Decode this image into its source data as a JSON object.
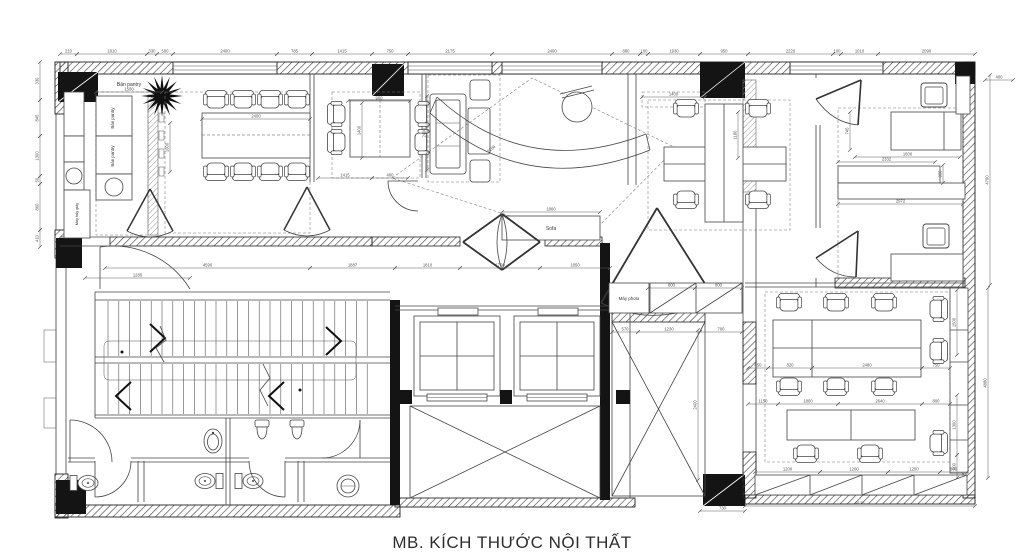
{
  "title": "MB. KÍCH THƯỚC NỘI THẤT",
  "labels": {
    "pantry_counter_top": "Bàn pantry",
    "pantry_counter_1": "Bàn pantry",
    "pantry_counter_2": "Bàn pantry",
    "paper_shredder": "Máy hủy giấy",
    "sofa_bench": "Sofa",
    "photocopier": "Máy photo"
  },
  "colors": {
    "wall": "#141414",
    "line": "#3f3f3f",
    "dim": "#5a5a5a",
    "text": "#2e2e2e"
  },
  "dimensions": {
    "horizontal": [
      [
        60,
        77,
        54,
        "210"
      ],
      [
        77,
        147,
        54,
        "1810"
      ],
      [
        147,
        157,
        54,
        "330"
      ],
      [
        157,
        173,
        54,
        "500"
      ],
      [
        173,
        277,
        54,
        "2400"
      ],
      [
        277,
        312,
        54,
        "785"
      ],
      [
        312,
        372,
        54,
        "1415"
      ],
      [
        372,
        408,
        54,
        "750"
      ],
      [
        408,
        492,
        54,
        "2175"
      ],
      [
        492,
        612,
        54,
        "2400"
      ],
      [
        612,
        640,
        54,
        "880"
      ],
      [
        640,
        648,
        54,
        "100"
      ],
      [
        648,
        700,
        54,
        "1930"
      ],
      [
        700,
        748,
        54,
        "950"
      ],
      [
        748,
        833,
        54,
        "2220"
      ],
      [
        833,
        841,
        54,
        "100"
      ],
      [
        841,
        878,
        54,
        "1010"
      ],
      [
        878,
        975,
        54,
        "2090"
      ],
      [
        96,
        162,
        92,
        "1500"
      ],
      [
        202,
        310,
        119,
        "2400"
      ],
      [
        348,
        410,
        101,
        "900"
      ],
      [
        318,
        372,
        178,
        "1415"
      ],
      [
        372,
        408,
        178,
        "400"
      ],
      [
        642,
        705,
        97,
        "1400"
      ],
      [
        502,
        600,
        212,
        "1800"
      ],
      [
        105,
        310,
        268,
        "4590"
      ],
      [
        310,
        395,
        268,
        "1887"
      ],
      [
        395,
        460,
        268,
        "1810"
      ],
      [
        460,
        540,
        268,
        "1750"
      ],
      [
        540,
        610,
        268,
        "1850"
      ],
      [
        85,
        190,
        278,
        "1280"
      ],
      [
        648,
        695,
        288,
        "800"
      ],
      [
        695,
        742,
        288,
        "800"
      ],
      [
        612,
        638,
        332,
        "570"
      ],
      [
        638,
        700,
        332,
        "1230"
      ],
      [
        700,
        742,
        332,
        "700"
      ],
      [
        855,
        960,
        157,
        "1600"
      ],
      [
        838,
        935,
        162,
        "2332"
      ],
      [
        838,
        963,
        204,
        "2972"
      ],
      [
        985,
        1013,
        80,
        "400"
      ],
      [
        748,
        768,
        368,
        "850"
      ],
      [
        768,
        812,
        368,
        "820"
      ],
      [
        812,
        922,
        368,
        "2480"
      ],
      [
        922,
        950,
        368,
        "750"
      ],
      [
        748,
        778,
        404,
        "1150"
      ],
      [
        778,
        838,
        404,
        "1800"
      ],
      [
        838,
        922,
        404,
        "2640"
      ],
      [
        922,
        950,
        404,
        "800"
      ],
      [
        755,
        820,
        472,
        "1200"
      ],
      [
        820,
        888,
        472,
        "1200"
      ],
      [
        888,
        940,
        472,
        "1200"
      ],
      [
        940,
        967,
        472,
        "800"
      ],
      [
        745,
        975,
        506,
        "9125"
      ],
      [
        700,
        745,
        511,
        "730"
      ]
    ],
    "vertical": [
      [
        62,
        100,
        40,
        "330"
      ],
      [
        100,
        136,
        40,
        "845"
      ],
      [
        136,
        176,
        40,
        "1300"
      ],
      [
        176,
        184,
        40,
        "50"
      ],
      [
        184,
        230,
        40,
        "860"
      ],
      [
        230,
        247,
        40,
        "410"
      ],
      [
        123,
        172,
        170,
        "1000"
      ],
      [
        103,
        158,
        362,
        "1400"
      ],
      [
        96,
        170,
        427,
        "2400"
      ],
      [
        112,
        150,
        850,
        "745"
      ],
      [
        165,
        183,
        943,
        "350"
      ],
      [
        112,
        158,
        738,
        "1180"
      ],
      [
        330,
        480,
        698,
        "2400"
      ],
      [
        75,
        285,
        990,
        "4790"
      ],
      [
        288,
        478,
        988,
        "4880"
      ],
      [
        290,
        355,
        957,
        "1500"
      ],
      [
        395,
        455,
        957,
        "1300"
      ],
      [
        455,
        478,
        957,
        "500"
      ]
    ],
    "diagonal": [
      [
        492,
        150,
        -38,
        "2186"
      ]
    ]
  }
}
